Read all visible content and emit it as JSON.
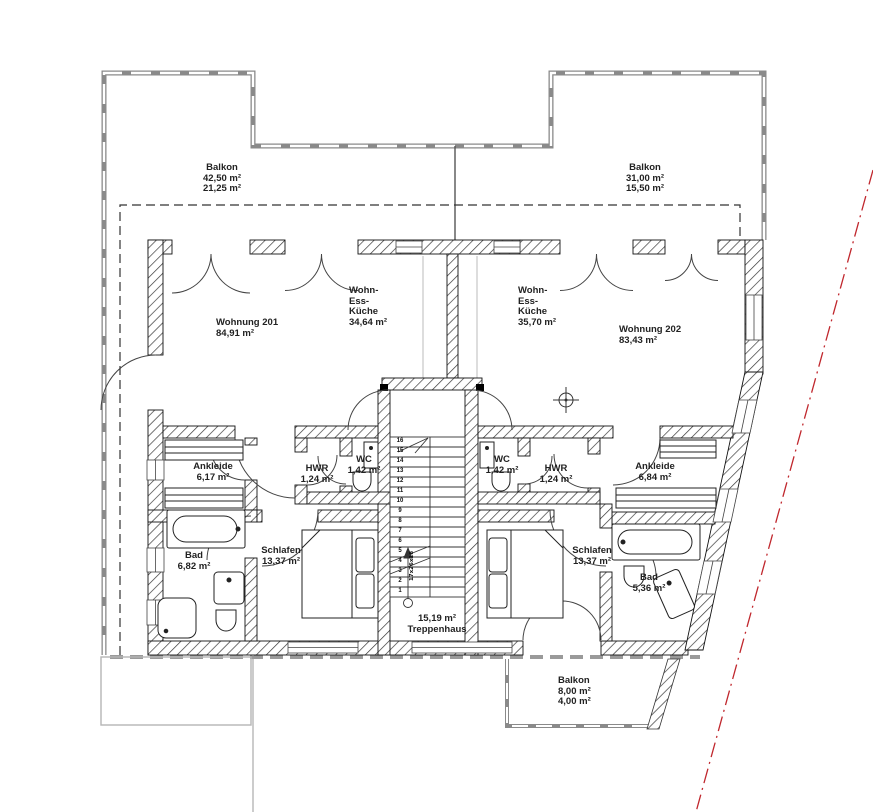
{
  "balconies": {
    "top_left": {
      "label": "Balkon",
      "area": "42,50 m²",
      "area_half": "21,25 m²"
    },
    "top_right": {
      "label": "Balkon",
      "area": "31,00 m²",
      "area_half": "15,50 m²"
    },
    "bottom": {
      "label": "Balkon",
      "area": "8,00 m²",
      "area_half": "4,00 m²"
    }
  },
  "apartments": {
    "left": {
      "label": "Wohnung 201",
      "area": "84,91 m²"
    },
    "right": {
      "label": "Wohnung 202",
      "area": "83,43 m²"
    }
  },
  "rooms": {
    "wek_left": {
      "line1": "Wohn-",
      "line2": "Ess-",
      "line3": "Küche",
      "area": "34,64 m²"
    },
    "wek_right": {
      "line1": "Wohn-",
      "line2": "Ess-",
      "line3": "Küche",
      "area": "35,70 m²"
    },
    "ankleide_left": {
      "label": "Ankleide",
      "area": "6,17 m²"
    },
    "hwr_left": {
      "label": "HWR",
      "area": "1,24 m²"
    },
    "wc_left": {
      "label": "WC",
      "area": "1,42 m²"
    },
    "wc_right": {
      "label": "WC",
      "area": "1,42 m²"
    },
    "hwr_right": {
      "label": "HWR",
      "area": "1,24 m²"
    },
    "ankleide_right": {
      "label": "Ankleide",
      "area": "6,84 m²"
    },
    "bad_left": {
      "label": "Bad",
      "area": "6,82 m²"
    },
    "schlafen_left": {
      "label": "Schlafen",
      "area": "13,37 m²"
    },
    "schlafen_right": {
      "label": "Schlafen",
      "area": "13,37 m²"
    },
    "bad_right": {
      "label": "Bad",
      "area": "5,36 m²"
    }
  },
  "stairwell": {
    "area": "15,19 m²",
    "label": "Treppenhaus",
    "dimension_note": "17x26x18",
    "steps": [
      "1",
      "2",
      "3",
      "4",
      "5",
      "6",
      "7",
      "8",
      "9",
      "10",
      "11",
      "12",
      "13",
      "14",
      "15",
      "16"
    ]
  },
  "colors": {
    "boundary_line": "#c0272d",
    "wall_line": "#111111",
    "rail_gray": "#8a8a8a"
  }
}
